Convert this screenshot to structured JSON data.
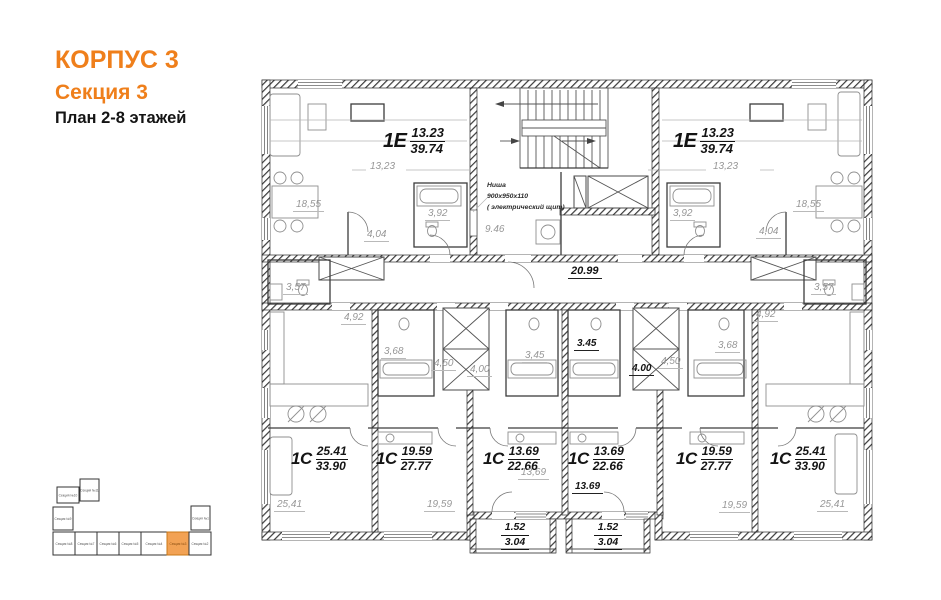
{
  "meta": {
    "accent_color": "#EF7F1B",
    "minimap_highlight_fill": "#F2A254",
    "wall_color": "#2b2b2b",
    "room_label_color": "#979797"
  },
  "header": {
    "building": "КОРПУС 3",
    "section": "Секция 3",
    "plan_title": "План 2-8 этажей"
  },
  "apartments": [
    {
      "type": "1Е",
      "area_living": "13.23",
      "area_total": "39.74"
    },
    {
      "type": "1Е",
      "area_living": "13.23",
      "area_total": "39.74"
    },
    {
      "type": "1С",
      "area_living": "25.41",
      "area_total": "33.90"
    },
    {
      "type": "1С",
      "area_living": "19.59",
      "area_total": "27.77"
    },
    {
      "type": "1С",
      "area_living": "13.69",
      "area_total": "22.66"
    },
    {
      "type": "1С",
      "area_living": "13.69",
      "area_total": "22.66"
    },
    {
      "type": "1С",
      "area_living": "19.59",
      "area_total": "27.77"
    },
    {
      "type": "1С",
      "area_living": "25.41",
      "area_total": "33.90"
    }
  ],
  "room_labels": {
    "living_left": "18,55",
    "living_right": "18,55",
    "bath_top_left": "3,92",
    "bath_top_right": "3,92",
    "hall_top_left": "4,04",
    "hall_top_right": "4,04",
    "bedroom_dim_left": "13,23",
    "bedroom_dim_right": "13,23",
    "wc_left": "3,57",
    "wc_right": "3,57",
    "corr_left": "4,92",
    "corr_right": "4,92",
    "bath_mid_l1": "3,68",
    "bath_mid_r1": "3,68",
    "hall_mid_l1": "4,50",
    "hall_mid_r1": "4,50",
    "hall_mid_l2": "4,00",
    "hall_mid_r2": "4.00",
    "bath_mid_l2": "3,45",
    "bath_mid_r2": "3.45",
    "room_l2": "13,69",
    "room_r2": "13.69",
    "room_l0": "25,41",
    "room_l1": "19,59",
    "room_r1": "19,59",
    "room_r0": "25,41",
    "lobby": "9.46",
    "corridor": "20.99"
  },
  "niche": {
    "line1": "Ниша",
    "line2": "900х950х110",
    "line3": "( электрический щит)"
  },
  "balconies": [
    {
      "top": "1.52",
      "bottom": "3.04"
    },
    {
      "top": "1.52",
      "bottom": "3.04"
    }
  ],
  "minimap": {
    "highlighted_label": "Секция №3",
    "sections": [
      {
        "label": "Секция №1"
      },
      {
        "label": "Секция №2"
      },
      {
        "label": "Секция №3"
      },
      {
        "label": "Секция №4"
      },
      {
        "label": "Секция №5"
      },
      {
        "label": "Секция №6"
      },
      {
        "label": "Секция №7"
      },
      {
        "label": "Секция №8"
      },
      {
        "label": "Секция №9"
      },
      {
        "label": "Секция №10"
      },
      {
        "label": "Секция №11"
      }
    ]
  }
}
